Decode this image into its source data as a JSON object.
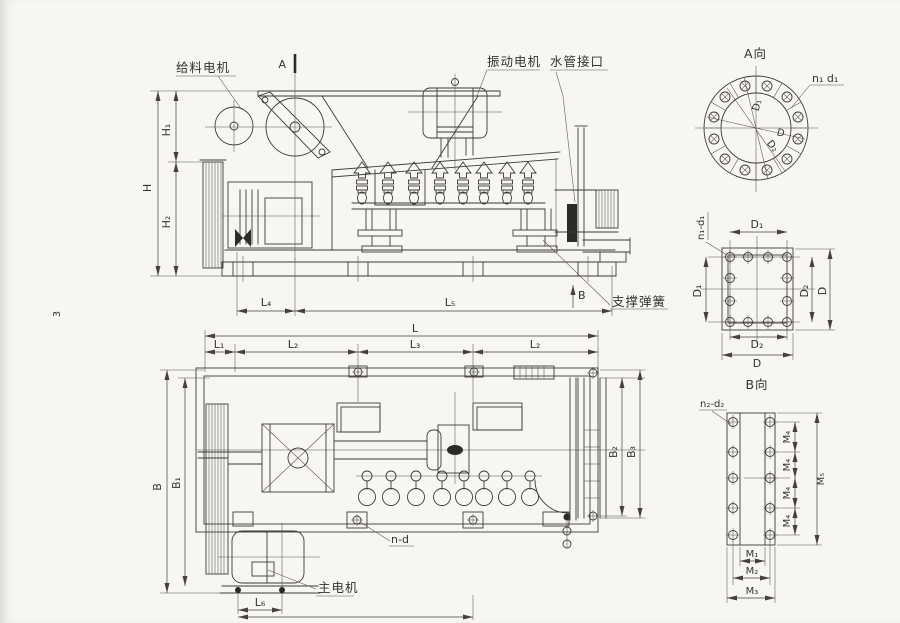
{
  "drawing": {
    "page_number": "3",
    "labels": {
      "feed_motor": "给料电机",
      "vibration_motor": "振动电机",
      "pipe_port": "水管接口",
      "support_spring": "支撑弹簧",
      "main_motor": "主电机",
      "view_a": "A向",
      "view_b": "B向",
      "section_a": "A",
      "section_b": "B",
      "holes_plan": "n-d",
      "holes_flange_a": "n₁ d₁",
      "holes_flange_b": "n₁-d₁",
      "holes_plate": "n₂-d₂"
    },
    "dims": {
      "H": "H",
      "H1": "H₁",
      "H2": "H₂",
      "L": "L",
      "L1": "L₁",
      "L2": "L₂",
      "L3": "L₃",
      "L4": "L₄",
      "L5": "L₅",
      "L6": "L₆",
      "B": "B",
      "B1": "B₁",
      "B2": "B₂",
      "B3": "B₃",
      "D": "D",
      "D1": "D₁",
      "D2": "D₂",
      "M1": "M₁",
      "M2": "M₂",
      "M3": "M₃",
      "M4": "M₄",
      "M5": "M₅"
    }
  }
}
